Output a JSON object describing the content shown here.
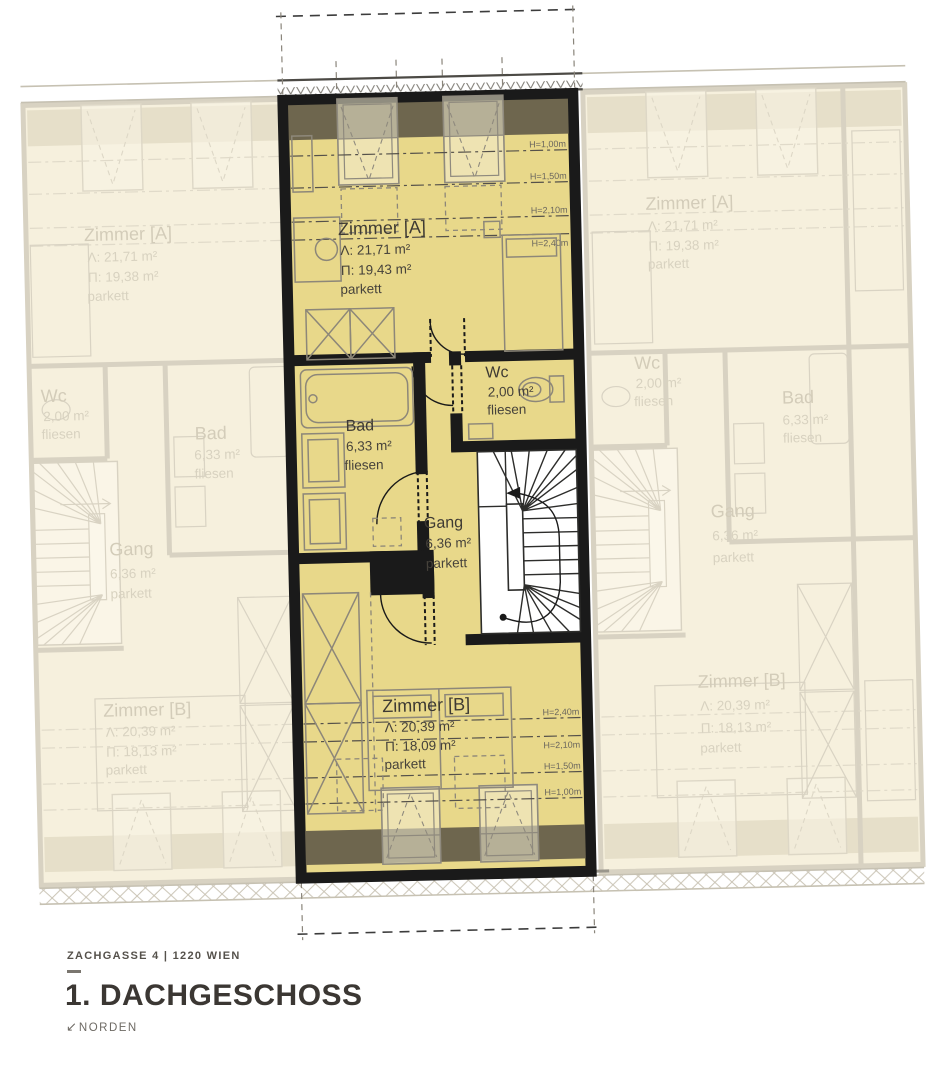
{
  "footer": {
    "address": "ZACHGASSE 4 | 1220 WIEN",
    "title": "1. DACHGESCHOSS",
    "north_arrow": "↙",
    "north_label": "NORDEN"
  },
  "central_unit": {
    "zimmer_a": {
      "name": "Zimmer [A]",
      "area_a": "Λ: 21,71 m²",
      "area_p": "Π: 19,43 m²",
      "floor": "parkett"
    },
    "bad": {
      "name": "Bad",
      "area": "6,33 m²",
      "floor": "fliesen"
    },
    "wc": {
      "name": "Wc",
      "area": "2,00 m²",
      "floor": "fliesen"
    },
    "gang": {
      "name": "Gang",
      "area": "6,36 m²",
      "floor": "parkett"
    },
    "zimmer_b": {
      "name": "Zimmer [B]",
      "area_a": "Λ: 20,39 m²",
      "area_p": "Π: 18,09 m²",
      "floor": "parkett"
    },
    "heights": {
      "h100": "H=1,00m",
      "h150": "H=1,50m",
      "h210": "H=2,10m",
      "h240": "H=2,40m"
    }
  },
  "left_unit": {
    "zimmer_a": {
      "name": "Zimmer [A]",
      "area_a": "Λ: 21,71 m²",
      "area_p": "Π: 19,38 m²",
      "floor": "parkett"
    },
    "bad": {
      "name": "Bad",
      "area": "6,33 m²",
      "floor": "fliesen"
    },
    "wc": {
      "name": "Wc",
      "area": "2,00 m²",
      "floor": "fliesen"
    },
    "gang": {
      "name": "Gang",
      "area": "6,36 m²",
      "floor": "parkett"
    },
    "zimmer_b": {
      "name": "Zimmer [B]",
      "area_a": "Λ: 20,39 m²",
      "area_p": "Π: 18,13 m²",
      "floor": "parkett"
    }
  },
  "right_unit": {
    "zimmer_a": {
      "name": "Zimmer [A]",
      "area_a": "Λ: 21,71 m²",
      "area_p": "Π: 19,38 m²",
      "floor": "parkett"
    },
    "bad": {
      "name": "Bad",
      "area": "6,33 m²",
      "floor": "fliesen"
    },
    "wc": {
      "name": "Wc",
      "area": "2,00 m²",
      "floor": "fliesen"
    },
    "gang": {
      "name": "Gang",
      "area": "6,36 m²",
      "floor": "parkett"
    },
    "zimmer_b": {
      "name": "Zimmer [B]",
      "area_a": "Λ: 20,39 m²",
      "area_p": "Π: 18,13 m²",
      "floor": "parkett"
    }
  },
  "colors": {
    "highlight_room_fill": "#e8d88a",
    "roof_band": "#6e664e",
    "wall": "#1a1a1a",
    "faded_fill": "#f6f0dd"
  }
}
